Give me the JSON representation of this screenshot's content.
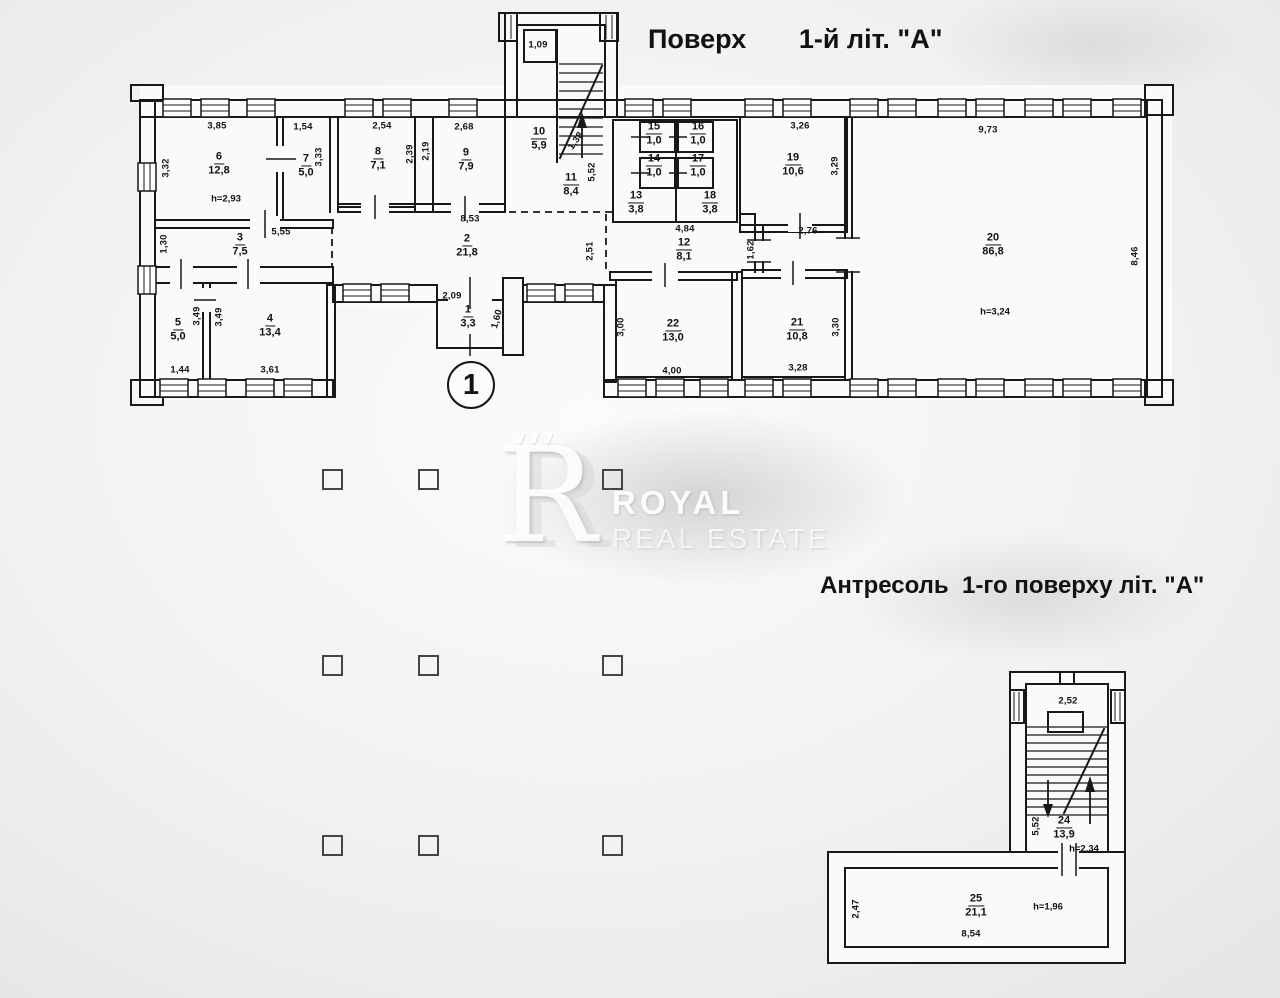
{
  "titles": {
    "floor1": "Поверх       1-й літ. \"А\"",
    "mezzanine": "Антресоль  1-го поверху літ. \"А\""
  },
  "plan_badge": "1",
  "watermark": {
    "monogram": "R",
    "line1": "ROYAL",
    "line2": "REAL ESTATE"
  },
  "floor1": {
    "rooms": [
      {
        "n": "1",
        "a": "3,3",
        "x": 468,
        "y": 317
      },
      {
        "n": "2",
        "a": "21,8",
        "x": 467,
        "y": 246
      },
      {
        "n": "3",
        "a": "7,5",
        "x": 240,
        "y": 245
      },
      {
        "n": "4",
        "a": "13,4",
        "x": 270,
        "y": 326
      },
      {
        "n": "5",
        "a": "5,0",
        "x": 178,
        "y": 330
      },
      {
        "n": "6",
        "a": "12,8",
        "x": 219,
        "y": 164
      },
      {
        "n": "7",
        "a": "5,0",
        "x": 306,
        "y": 166
      },
      {
        "n": "8",
        "a": "7,1",
        "x": 378,
        "y": 159
      },
      {
        "n": "9",
        "a": "7,9",
        "x": 466,
        "y": 160
      },
      {
        "n": "10",
        "a": "5,9",
        "x": 539,
        "y": 139
      },
      {
        "n": "11",
        "a": "8,4",
        "x": 571,
        "y": 185
      },
      {
        "n": "12",
        "a": "8,1",
        "x": 684,
        "y": 250
      },
      {
        "n": "13",
        "a": "3,8",
        "x": 636,
        "y": 203
      },
      {
        "n": "14",
        "a": "1,0",
        "x": 654,
        "y": 166
      },
      {
        "n": "15",
        "a": "1,0",
        "x": 654,
        "y": 134
      },
      {
        "n": "16",
        "a": "1,0",
        "x": 698,
        "y": 134
      },
      {
        "n": "17",
        "a": "1,0",
        "x": 698,
        "y": 166
      },
      {
        "n": "18",
        "a": "3,8",
        "x": 710,
        "y": 203
      },
      {
        "n": "19",
        "a": "10,6",
        "x": 793,
        "y": 165
      },
      {
        "n": "20",
        "a": "86,8",
        "x": 993,
        "y": 245
      },
      {
        "n": "21",
        "a": "10,8",
        "x": 797,
        "y": 330
      },
      {
        "n": "22",
        "a": "13,0",
        "x": 673,
        "y": 331
      }
    ],
    "notes": [
      {
        "t": "h=2,93",
        "x": 226,
        "y": 199
      },
      {
        "t": "h=3,24",
        "x": 995,
        "y": 312
      }
    ],
    "dims": [
      {
        "t": "3,85",
        "x": 217,
        "y": 126
      },
      {
        "t": "1,54",
        "x": 303,
        "y": 127
      },
      {
        "t": "2,54",
        "x": 382,
        "y": 126
      },
      {
        "t": "2,68",
        "x": 464,
        "y": 127
      },
      {
        "t": "1,09",
        "x": 538,
        "y": 45
      },
      {
        "t": "3,26",
        "x": 800,
        "y": 126
      },
      {
        "t": "9,73",
        "x": 988,
        "y": 130
      },
      {
        "t": "3,32",
        "x": 166,
        "y": 168,
        "r": -90
      },
      {
        "t": "3,33",
        "x": 319,
        "y": 157,
        "r": -90
      },
      {
        "t": "2,39",
        "x": 410,
        "y": 154,
        "r": -90
      },
      {
        "t": "2,19",
        "x": 426,
        "y": 151,
        "r": -90
      },
      {
        "t": "1,38",
        "x": 576,
        "y": 141,
        "r": -55
      },
      {
        "t": "5,52",
        "x": 592,
        "y": 172,
        "r": -90
      },
      {
        "t": "1,30",
        "x": 164,
        "y": 244,
        "r": -90
      },
      {
        "t": "5,55",
        "x": 281,
        "y": 232
      },
      {
        "t": "8,53",
        "x": 470,
        "y": 219
      },
      {
        "t": "4,84",
        "x": 685,
        "y": 229
      },
      {
        "t": "2,76",
        "x": 808,
        "y": 231
      },
      {
        "t": "2,51",
        "x": 590,
        "y": 251,
        "r": -90
      },
      {
        "t": "1,62",
        "x": 751,
        "y": 250,
        "r": -90
      },
      {
        "t": "3,29",
        "x": 835,
        "y": 166,
        "r": -90
      },
      {
        "t": "8,46",
        "x": 1135,
        "y": 256,
        "r": -90
      },
      {
        "t": "2,09",
        "x": 452,
        "y": 296
      },
      {
        "t": "1,60",
        "x": 497,
        "y": 319,
        "r": -75
      },
      {
        "t": "3,49",
        "x": 197,
        "y": 316,
        "r": -90
      },
      {
        "t": "3,49",
        "x": 219,
        "y": 317,
        "r": -90
      },
      {
        "t": "1,44",
        "x": 180,
        "y": 370
      },
      {
        "t": "3,61",
        "x": 270,
        "y": 370
      },
      {
        "t": "3,00",
        "x": 621,
        "y": 327,
        "r": -90
      },
      {
        "t": "4,00",
        "x": 672,
        "y": 371
      },
      {
        "t": "3,30",
        "x": 836,
        "y": 327,
        "r": -90
      },
      {
        "t": "3,28",
        "x": 798,
        "y": 368
      }
    ]
  },
  "mezzanine": {
    "rooms": [
      {
        "n": "24",
        "a": "13,9",
        "x": 1064,
        "y": 828
      },
      {
        "n": "25",
        "a": "21,1",
        "x": 976,
        "y": 906
      }
    ],
    "notes": [
      {
        "t": "h=2,34",
        "x": 1084,
        "y": 849
      },
      {
        "t": "h=1,96",
        "x": 1048,
        "y": 907
      }
    ],
    "dims": [
      {
        "t": "2,52",
        "x": 1068,
        "y": 701
      },
      {
        "t": "5,52",
        "x": 1036,
        "y": 826,
        "r": -90
      },
      {
        "t": "2,47",
        "x": 856,
        "y": 909,
        "r": -90
      },
      {
        "t": "8,54",
        "x": 971,
        "y": 934
      }
    ]
  }
}
